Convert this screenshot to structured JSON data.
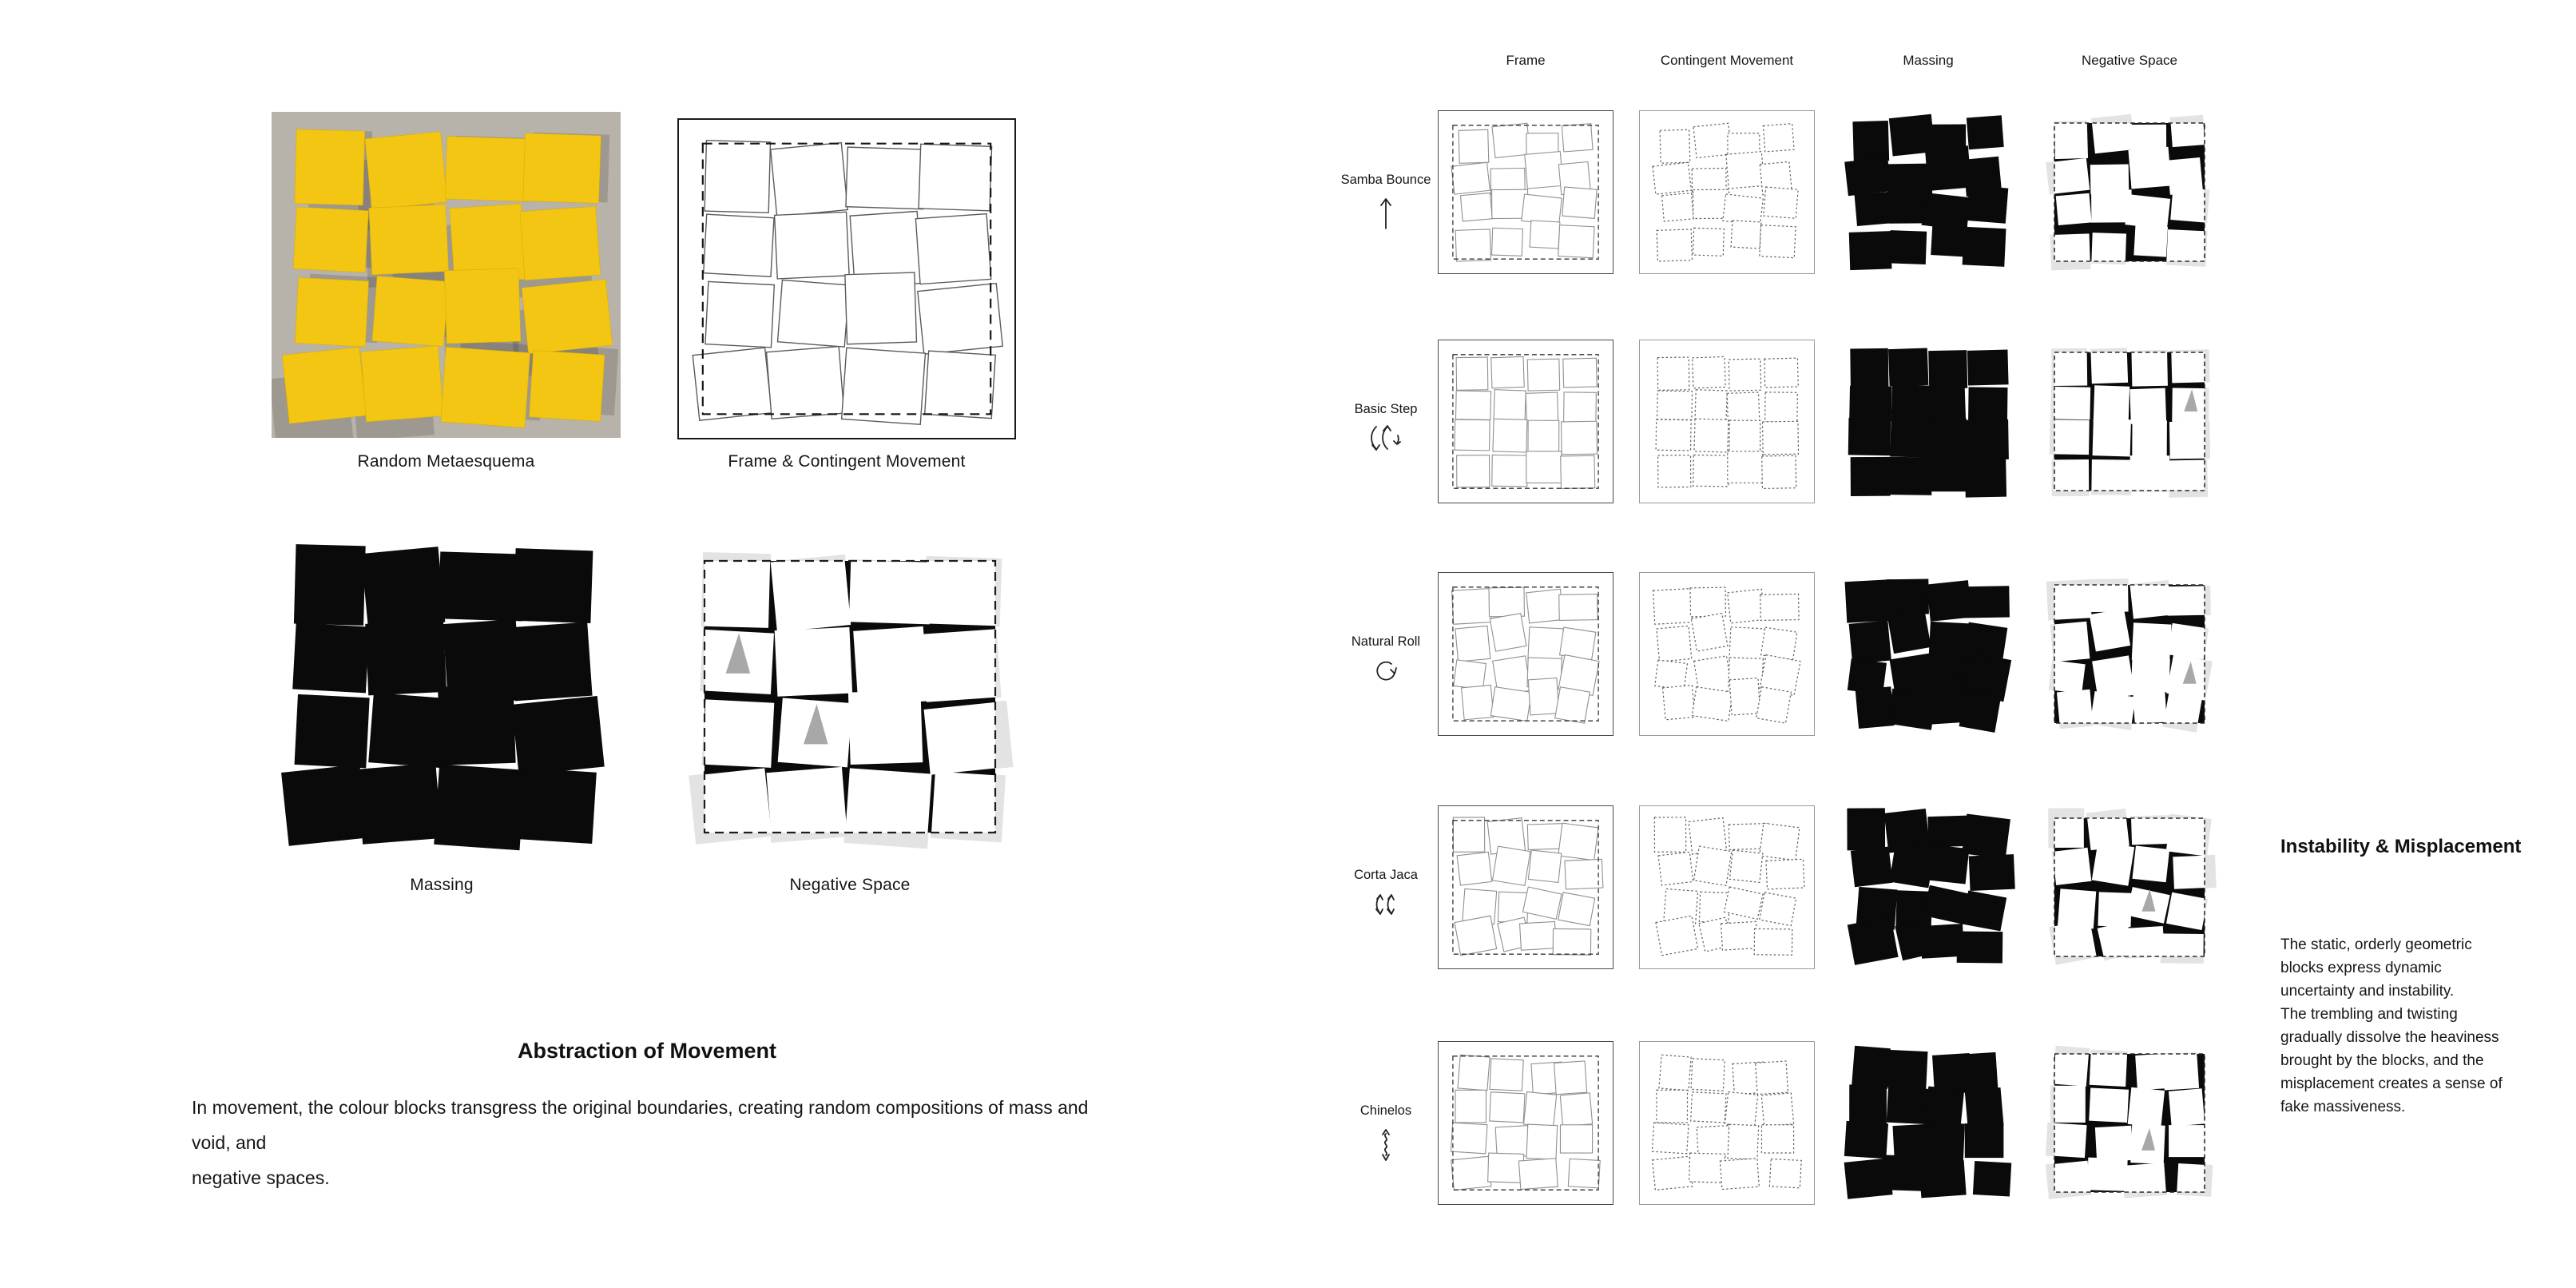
{
  "left": {
    "panels": [
      {
        "caption": "Random Metaesquema",
        "type": "photo"
      },
      {
        "caption": "Frame & Contingent Movement",
        "type": "frame"
      },
      {
        "caption": "Massing",
        "type": "massing"
      },
      {
        "caption": "Negative Space",
        "type": "negative"
      }
    ],
    "title": "Abstraction of Movement",
    "body": "In movement, the colour blocks transgress the original boundaries, creating random compositions of mass and void, and\nnegative spaces."
  },
  "matrix": {
    "column_headers": [
      "Frame",
      "Contingent Movement",
      "Massing",
      "Negative Space"
    ],
    "rows": [
      {
        "label": "Samba Bounce",
        "icon": "arrow-up-icon"
      },
      {
        "label": "Basic Step",
        "icon": "swing-arrows-icon"
      },
      {
        "label": "Natural Roll",
        "icon": "rotate-clockwise-icon"
      },
      {
        "label": "Corta Jaca",
        "icon": "double-swing-arrows-icon"
      },
      {
        "label": "Chinelos",
        "icon": "vertical-wave-arrow-icon"
      }
    ]
  },
  "aside": {
    "title": "Instability &  Misplacement",
    "body": "The static, orderly geometric\nblocks express dynamic\nuncertainty and instability.\nThe trembling and twisting\ngradually dissolve the heaviness\nbrought by the blocks, and the\nmisplacement creates a sense of\nfake massiveness."
  },
  "colors": {
    "paper_yellow": "#F3C613",
    "cardboard_gray": "#B7B3AA",
    "block_black": "#0A0A0A",
    "spill_gray": "#E3E3E3",
    "accent_gray": "#A8A8A8",
    "outline_gray": "#8F8F8F"
  }
}
